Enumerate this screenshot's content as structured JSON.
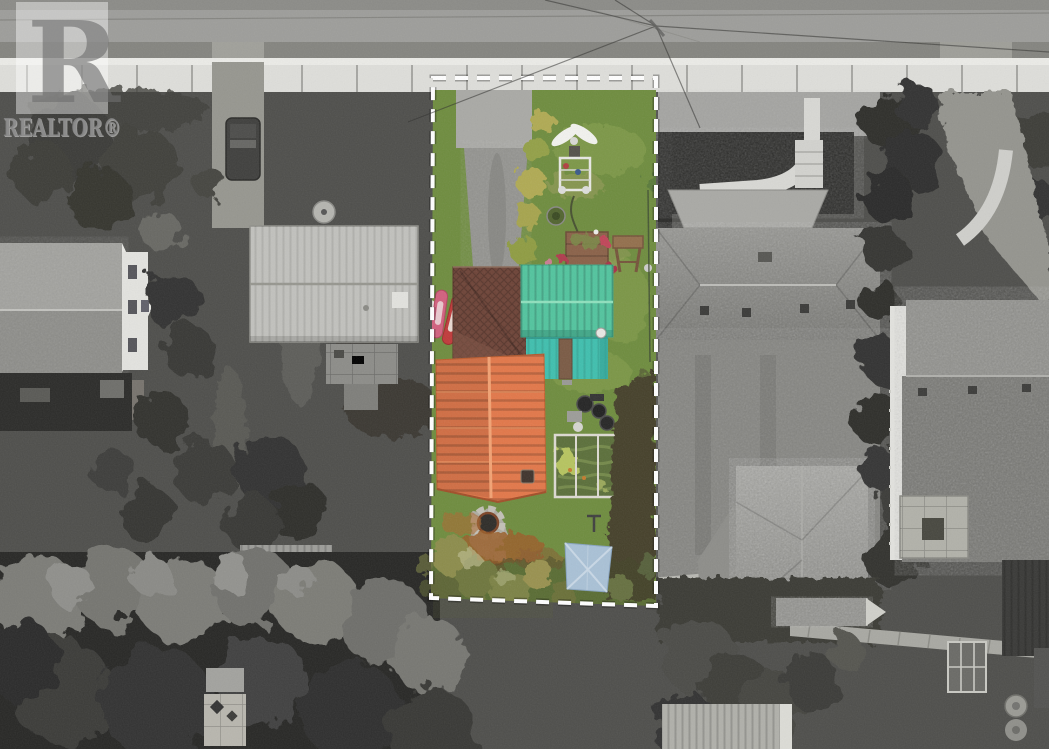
{
  "watermark": {
    "logo_letter": "R",
    "brand_label": "REALTOR®"
  },
  "colors": {
    "ground_gray": "#4e4e4b",
    "road_gray": "#9d9d9a",
    "shoulder_gray": "#84847f",
    "sidewalk_gray": "#dededa",
    "driveway_gray": "#91918d",
    "grass": "#6e8c3e",
    "grass_light": "#8fa652",
    "hedge_yellow": "#b0aa52",
    "teal_roof": "#52c49e",
    "teal_wall": "#3fbfae",
    "orange_roof": "#e27749",
    "brown_roof": "#6d4337",
    "leaf_litter": "#9a5e2c",
    "tarp_blue": "#a9c1d6",
    "boundary_white": "#ffffff"
  }
}
